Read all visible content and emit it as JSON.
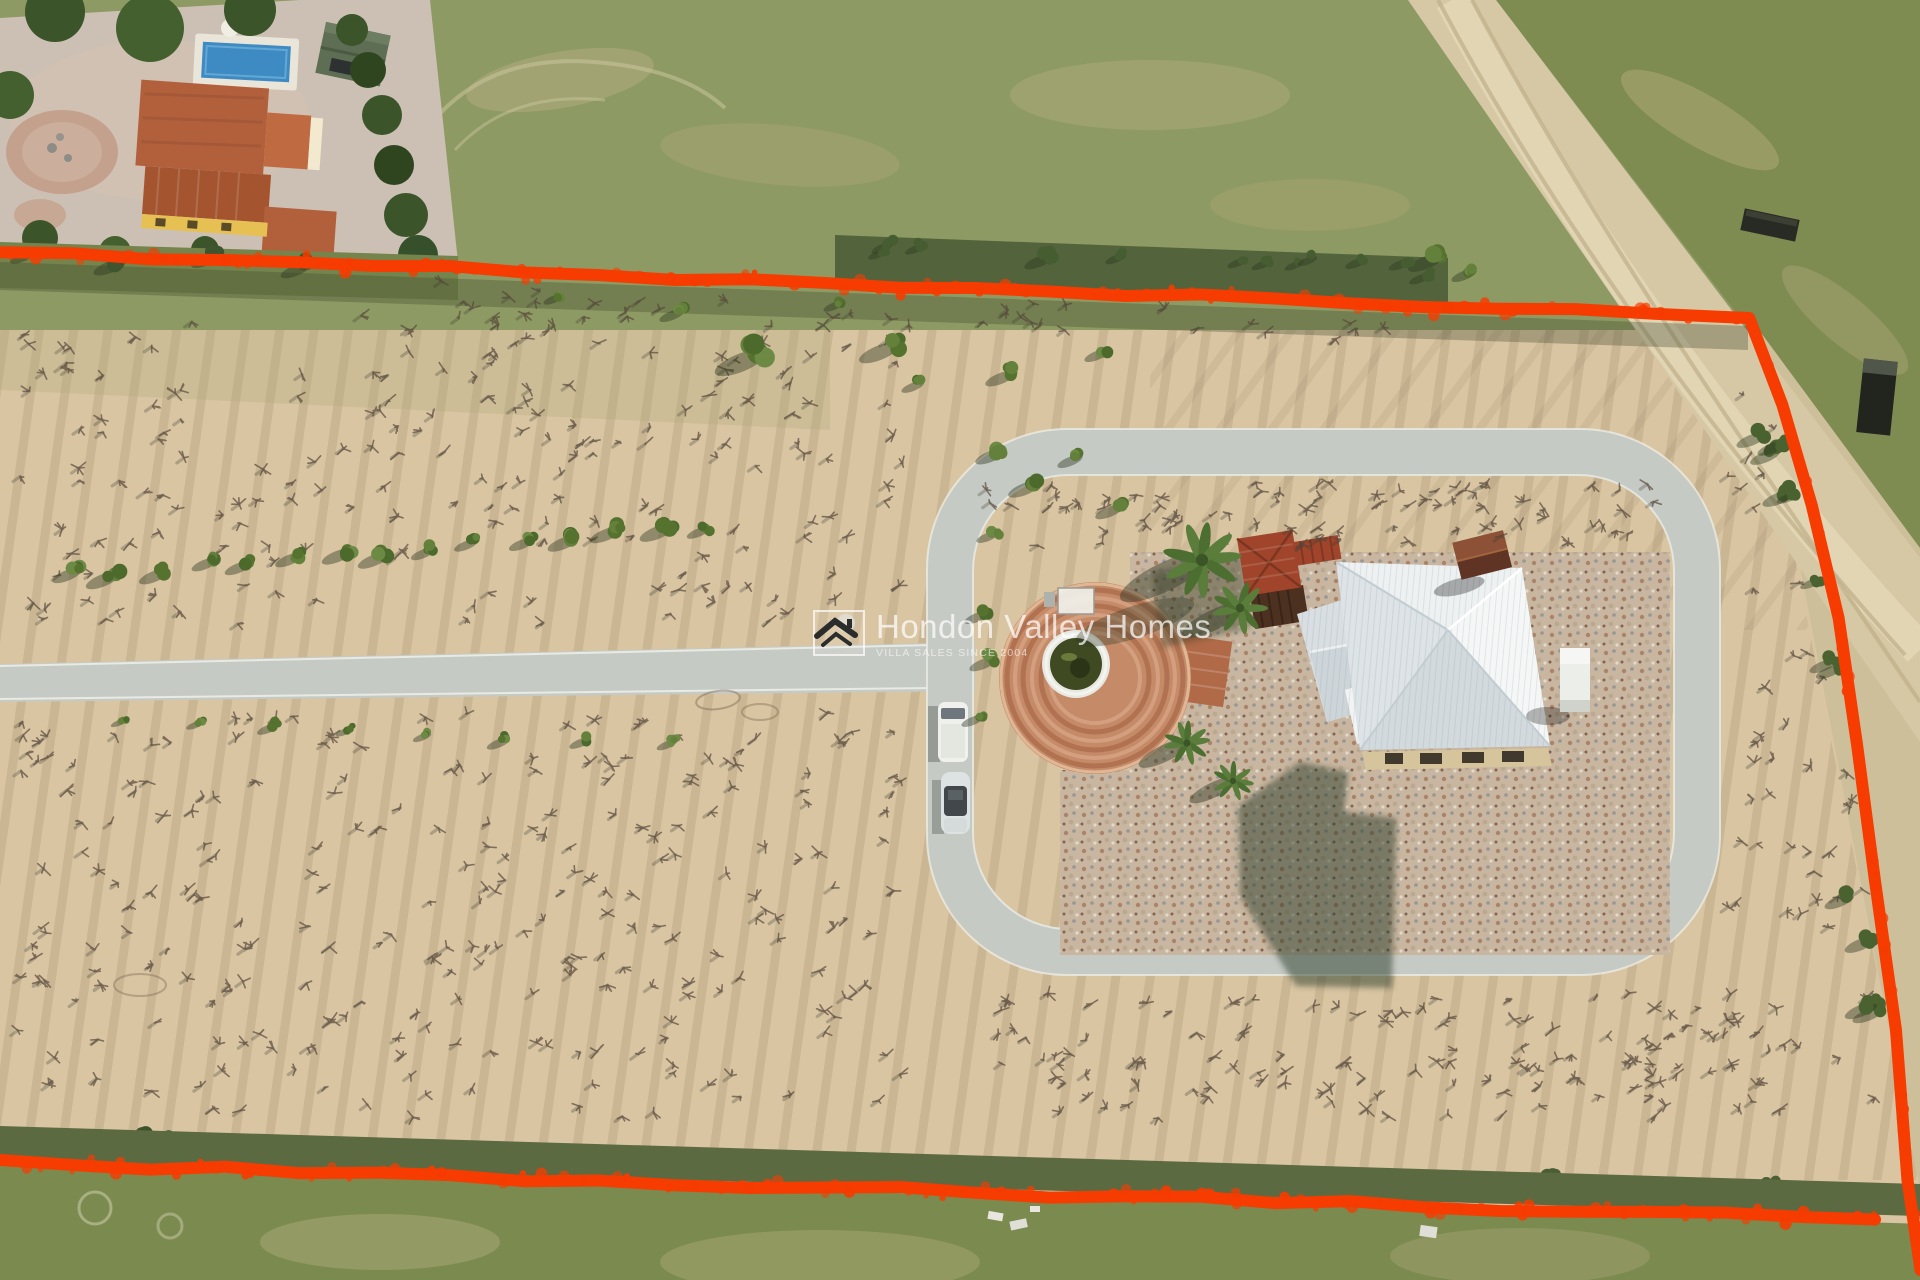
{
  "watermark": {
    "title": "Hondon Valley Homes",
    "tagline": "VILLA SALES SINCE 2004",
    "logo_icon": "house-roof-icon",
    "logo_sun_icon": "sun-dot-icon"
  },
  "colors": {
    "boundary_red": "#f63c00",
    "villa_roof_white": "#eef1f2",
    "pool_blue": "#3e8ac2",
    "road_concrete": "#c6cac4",
    "dirt_road": "#d6c8a5",
    "field_sand": "#d9c5a2",
    "field_green": "#8e9a63",
    "plaza_terracotta": "#c58a68",
    "gazebo_roof": "#a0452b"
  }
}
